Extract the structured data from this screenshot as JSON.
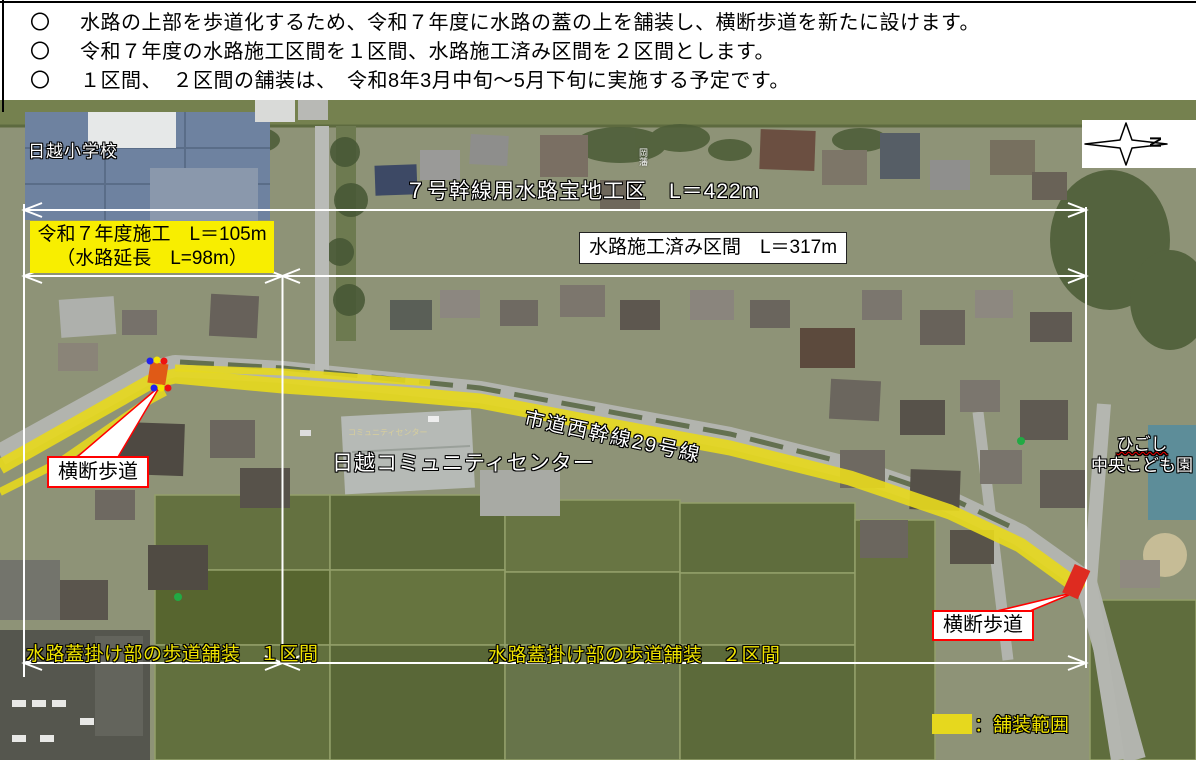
{
  "header": {
    "bullets": [
      {
        "marker": "〇",
        "text": "水路の上部を歩道化するため、令和７年度に水路の蓋の上を舗装し、横断歩道を新たに設けます。"
      },
      {
        "marker": "〇",
        "text": "令和７年度の水路施工区間を１区間、水路施工済み区間を２区間とします。"
      },
      {
        "marker": "〇",
        "text": "１区間、　２区間の舗装は、　令和8年3月中旬～5月下旬に実施する予定です。"
      }
    ]
  },
  "annotations": {
    "trunk_section_label": "７号幹線用水路宝地工区　L＝422m",
    "fy7_box": {
      "line1": "令和７年度施工　L＝105m",
      "line2": "（水路延長　L=98m）"
    },
    "completed_box_label": "水路施工済み区間　L＝317m",
    "road_name": "市道西幹線29号線",
    "crosswalk_left": "横断歩道",
    "crosswalk_right": "横断歩道",
    "section1_label": "水路蓋掛け部の歩道舗装　１区間",
    "section2_label": "水路蓋掛け部の歩道舗装　２区間",
    "legend_label": "：舗装範囲"
  },
  "map_labels": {
    "school": "日越小学校",
    "community_center": "日越コミュニティセンター",
    "kodomoen_line1": "ひごし",
    "kodomoen_line2": "中央こども園",
    "small_place_vertical": "岡藩",
    "roof_text": "コミュニティセンター"
  },
  "compass": {
    "letter": "N"
  },
  "colors": {
    "paving_yellow": "#e6d81e",
    "highlight_box_yellow": "#f8ee00",
    "label_yellow": "#f0e400",
    "callout_red": "#ff1111",
    "dimension_white": "#ffffff",
    "dot_blue": "#2222ee",
    "dot_yellow": "#f5e400",
    "dot_red": "#ee1111",
    "crosswalk_marker_left": "#e05a16",
    "crosswalk_marker_right": "#de2b20"
  }
}
